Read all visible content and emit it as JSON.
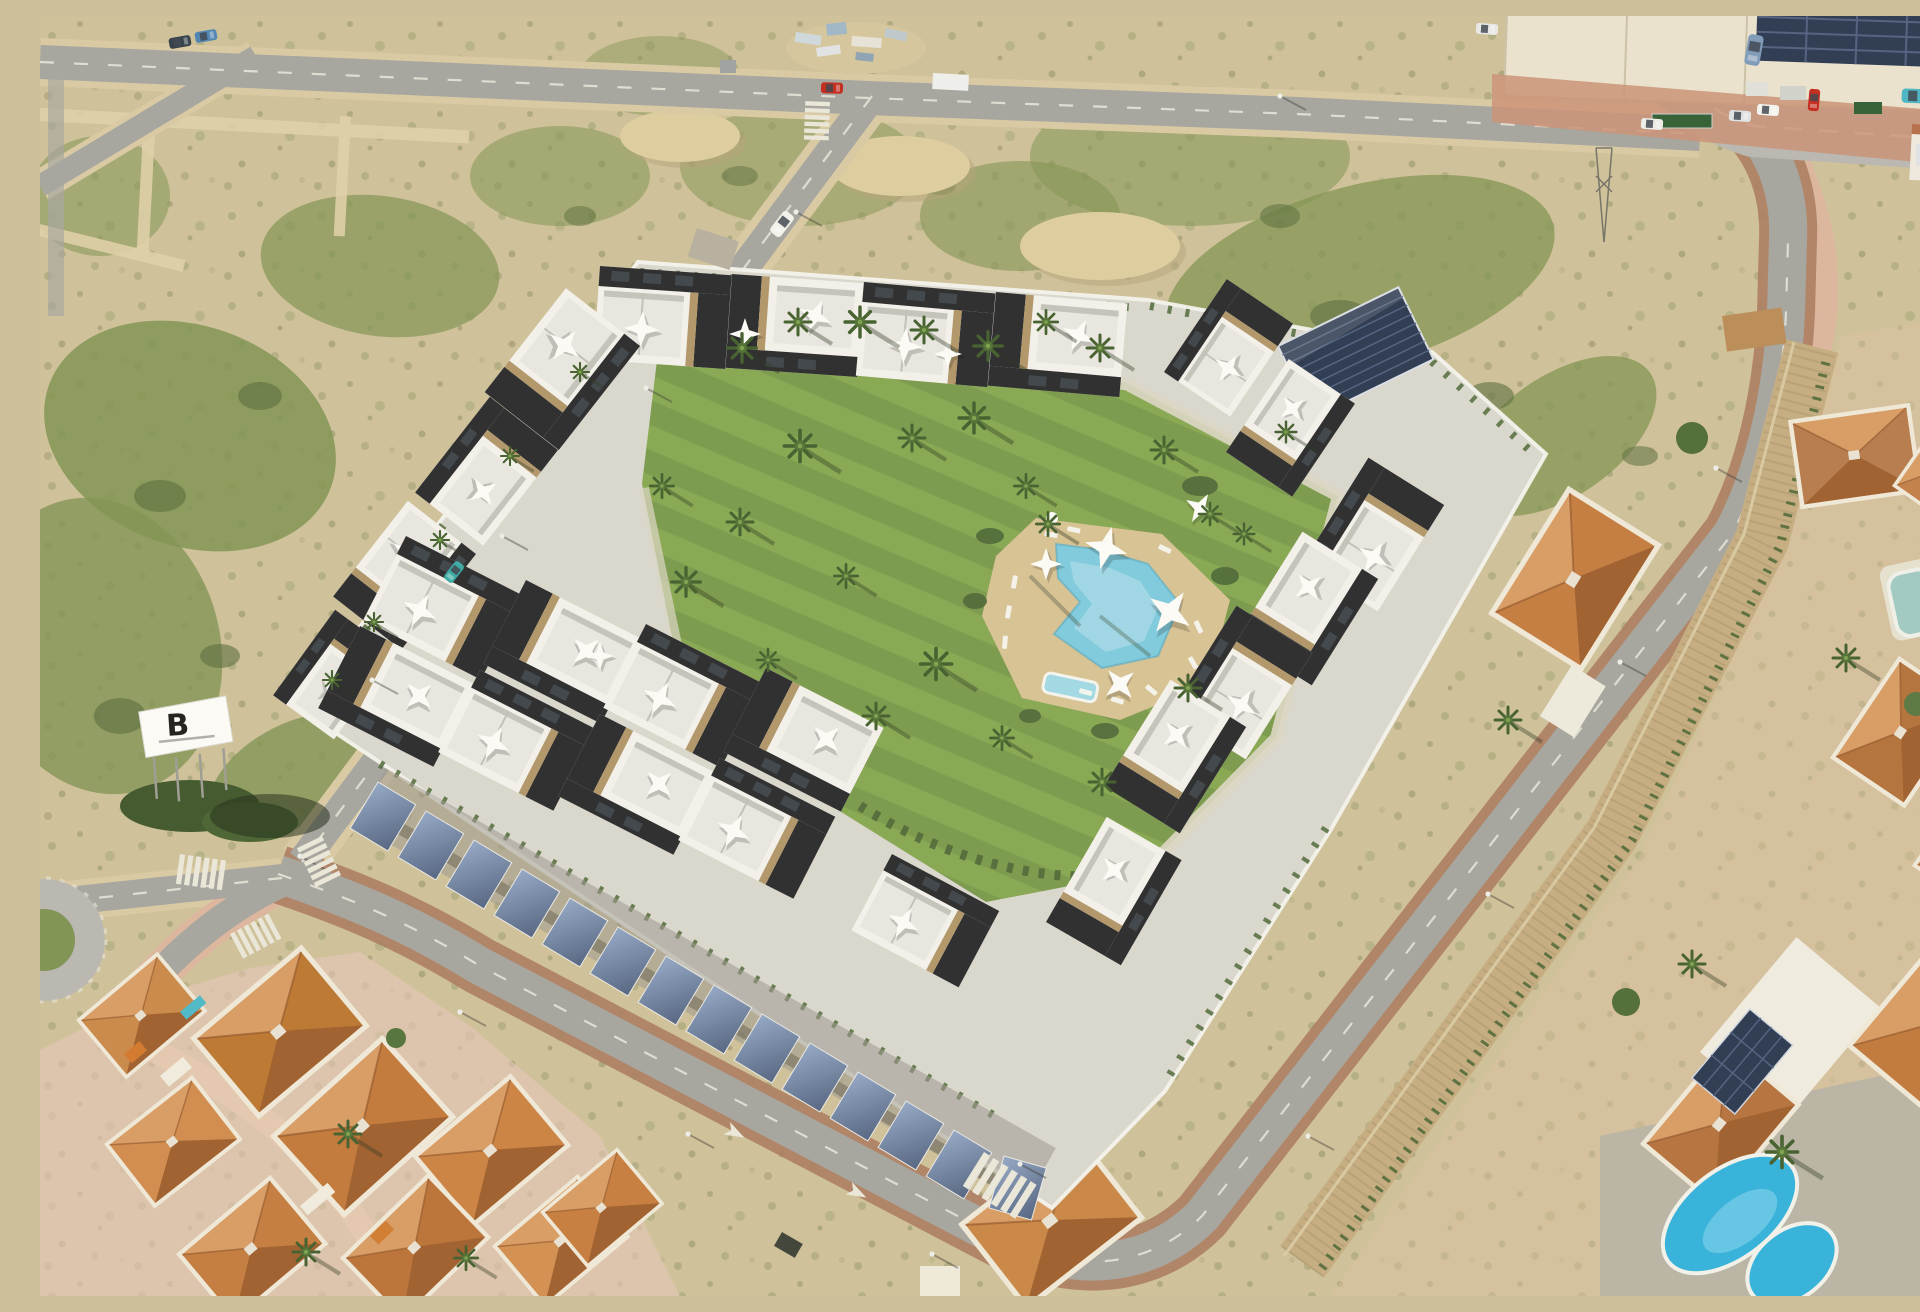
{
  "scene": {
    "type": "aerial-photograph",
    "subject": "aerial render of a new-build residential complex with central lawn and pool, bordered by roads, scrubland, a highway with warehouse, an old terracotta-roof neighborhood and villas with private pools"
  },
  "billboard": {
    "letter": "B"
  },
  "palette": {
    "sand": "#cdbf99",
    "sandLight": "#ded0aa",
    "dirt": "#dccc9f",
    "scrub": "#7d9150",
    "scrubDark": "#55693a",
    "road": "#a3a39f",
    "roadLight": "#b7b6b2",
    "lane": "#e9e7dc",
    "fringe": "#d9c9a4",
    "pinkWalk": "#dcb49e",
    "bikeLane": "#a97a5f",
    "lawnA": "#83a651",
    "lawnB": "#78984a",
    "hedge": "#4a6535",
    "deck": "#d6c194",
    "pool": "#7ccadf",
    "poolLight": "#a9dcea",
    "poolDeep": "#4fa8c6",
    "poolBright": "#2fb0dc",
    "concrete": "#d8d6ce",
    "wall": "#f3f3ee",
    "path": "#dcd6c6",
    "bWhite": "#f2f1ec",
    "bDark": "#26282c",
    "bStone": "#ae9468",
    "bTerr": "#e7e6e1",
    "glass": "#394147",
    "solarDark": "#27354f",
    "solarLine": "#4c5e7f",
    "roofMain": "#c07c46",
    "roofLight": "#d79a62",
    "roofDark": "#9e5c2c",
    "roofWall": "#efe8d9",
    "stoneWall": "#c3ab80",
    "patio": "#b8b3a6",
    "warehouse": "#e9e2cf",
    "apron": "#c98f76",
    "signGreen": "#2e5c33"
  }
}
